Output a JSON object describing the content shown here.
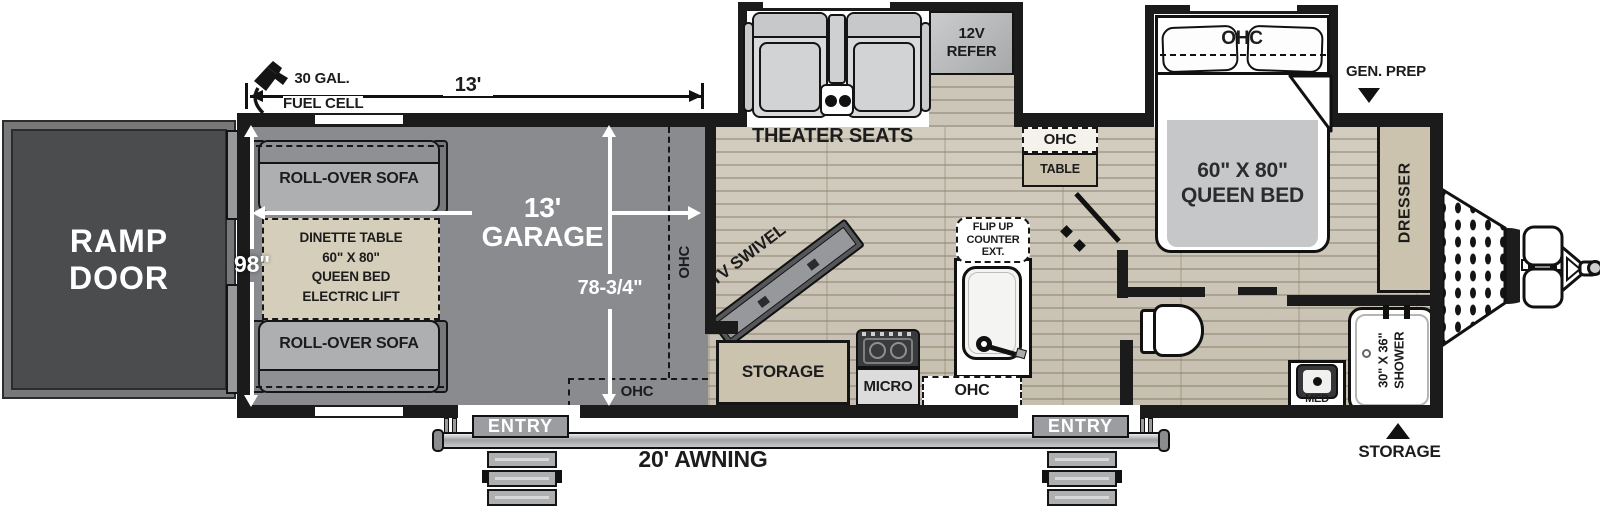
{
  "ramp": {
    "line1": "RAMP",
    "line2": "DOOR"
  },
  "dims": {
    "fuel1": "30 GAL.",
    "fuel2": "FUEL CELL",
    "length": "13'",
    "width": "98\"",
    "garage1": "13'",
    "garage2": "GARAGE",
    "garage_width": "78-3/4\"",
    "awning": "20' AWNING"
  },
  "garage": {
    "sofa_top": "ROLL-OVER SOFA",
    "sofa_bottom": "ROLL-OVER SOFA",
    "dinette1": "DINETTE TABLE",
    "dinette2": "60\" X 80\"",
    "dinette3": "QUEEN BED",
    "dinette4": "ELECTRIC LIFT",
    "ohc_side": "OHC",
    "ohc_bottom": "OHC"
  },
  "living": {
    "theater": "THEATER SEATS",
    "refer1": "12V",
    "refer2": "REFER",
    "tv": "TV SWIVEL",
    "storage": "STORAGE",
    "micro": "MICRO",
    "flip1": "FLIP UP",
    "flip2": "COUNTER",
    "flip3": "EXT.",
    "ohc_kitchen": "OHC",
    "ohc_upper": "OHC",
    "table": "TABLE"
  },
  "bedroom": {
    "ohc": "OHC",
    "bed1": "60\" X 80\"",
    "bed2": "QUEEN BED",
    "gen_prep": "GEN. PREP",
    "dresser": "DRESSER"
  },
  "bath": {
    "med": "MED",
    "shower1": "30\" X 36\"",
    "shower2": "SHOWER",
    "storage": "STORAGE"
  },
  "doors": {
    "entry_left": "ENTRY",
    "entry_right": "ENTRY"
  },
  "colors": {
    "wall": "#1b1b1b",
    "garage_floor": "#8a8b8e",
    "wood_floor": "#ccc6b8",
    "cabinet_tan": "#cbc3ae",
    "ramp_door": "#4b4c4e",
    "furniture_gray": "#aeafb1"
  }
}
